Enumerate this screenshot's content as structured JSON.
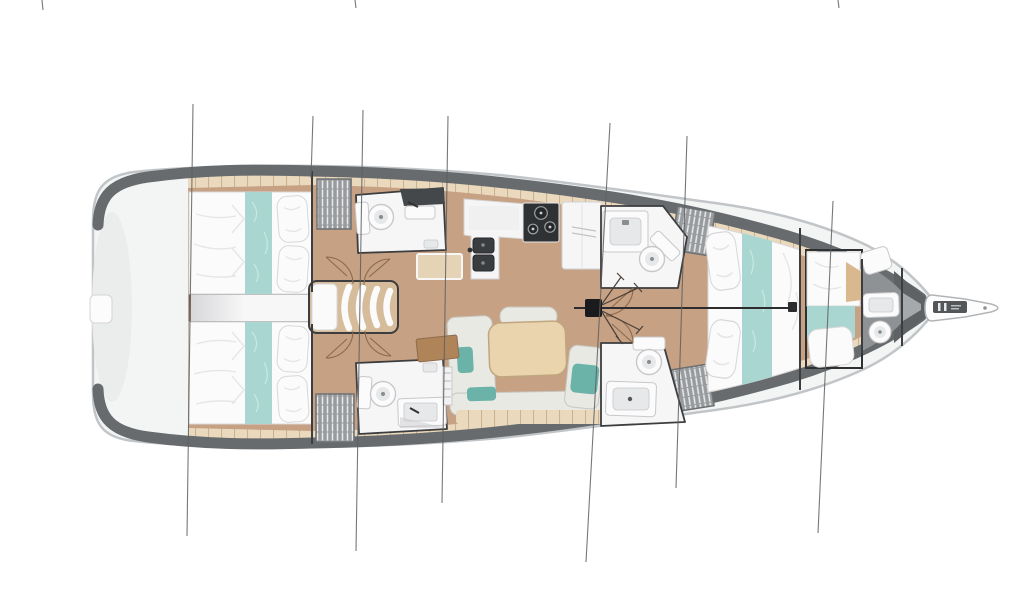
{
  "page": {
    "background": "#ffffff",
    "description": "Top-down interior layout plan of a sailing yacht, bow pointing right: stern swim platform, two aft double cabins with teal bed runners, two aft heads with toilet and vanity, companionway stairs, linear galley with twin sinks, three-burner stove and fridge unit, saloon with U-shaped settee, teal cushions and wooden table, two forward heads, forward double cabin, bow cabin with transverse berth, forepeak washroom, bowsprit with anchor roller, mast with forestay and seven rigging stay lines crossing the hull."
  },
  "colors": {
    "background": "#ffffff",
    "hullEdge": "#c2c5c8",
    "hullWhite": "#f3f4f4",
    "deckDark": "#676b6e",
    "bowDark": "#5e6265",
    "floorTan": "#c7a183",
    "plankLight": "#ead9bc",
    "plankLine": "#cbb391",
    "roomWhite": "#f6f6f7",
    "wall": "#3c3d3f",
    "corridorLight": "#f7f7f8",
    "corridorShade": "#d7d7d9",
    "fixtureWhite": "#fbfbfc",
    "fixtureShade": "#e7e8e9",
    "fixtureLine": "#c8c8cb",
    "darkCounter": "#45484b",
    "sinkDark": "#3a3d40",
    "stoveDark": "#2f3235",
    "teal": "#a9d6d0",
    "tealSoft": "#6bb3a8",
    "tealLine": "#c9e8e3",
    "cream": "#e9e9e4",
    "creamEdge": "#c7c7c2",
    "tableWood": "#ead4ae",
    "tableEdge": "#c0a67e",
    "brown": "#b08459",
    "wardrobeGray": "#989b9e",
    "wardrobeLine": "#6d7073",
    "wardrobeHatch": "#e9eaea",
    "forepeakGray": "#8f9295",
    "forepeakLight": "#a6a9ac",
    "headboardTan": "#d9b88f",
    "mast": "#1b1b1d",
    "rig": "#5e6062",
    "rigDark": "#2c2c2e",
    "doorArc": "#8a6a4d",
    "bedWhite": "#fbfbfc",
    "bedShade": "#e6e6e8",
    "bedLine": "#d8d8da"
  },
  "vessel": {
    "orientation": "bow-right",
    "rooms": [
      {
        "name": "stern-swim-platform"
      },
      {
        "name": "aft-cabin-port",
        "features": [
          "double-berth",
          "teal-runner",
          "two-pillows"
        ]
      },
      {
        "name": "aft-cabin-starboard",
        "features": [
          "double-berth",
          "teal-runner",
          "two-pillows"
        ]
      },
      {
        "name": "aft-head-port",
        "features": [
          "toilet",
          "vanity-sink"
        ]
      },
      {
        "name": "aft-head-starboard",
        "features": [
          "toilet",
          "vanity-sink"
        ]
      },
      {
        "name": "companionway-stairs",
        "features": [
          "four-treads"
        ]
      },
      {
        "name": "galley",
        "features": [
          "double-sink",
          "three-burner-stove",
          "fridge-unit"
        ]
      },
      {
        "name": "saloon",
        "features": [
          "u-shaped-settee",
          "teal-cushions",
          "dining-table",
          "sideboard"
        ]
      },
      {
        "name": "forward-head-port",
        "features": [
          "toilet",
          "sink"
        ]
      },
      {
        "name": "forward-head-starboard",
        "features": [
          "toilet",
          "sink"
        ]
      },
      {
        "name": "forward-cabin",
        "features": [
          "double-berth",
          "teal-runner",
          "two-pillows"
        ]
      },
      {
        "name": "bow-cabin",
        "features": [
          "transverse-berth",
          "teal-runner",
          "pillow",
          "headboard"
        ]
      },
      {
        "name": "forepeak-washroom",
        "features": [
          "toilet",
          "sink",
          "seat"
        ]
      },
      {
        "name": "bow-locker"
      },
      {
        "name": "bowsprit",
        "features": [
          "anchor-roller"
        ]
      }
    ],
    "wardrobes": 4,
    "rigging": {
      "mast": 1,
      "forestay": 1,
      "stay_lines": 7,
      "edge_ticks": 3
    }
  }
}
